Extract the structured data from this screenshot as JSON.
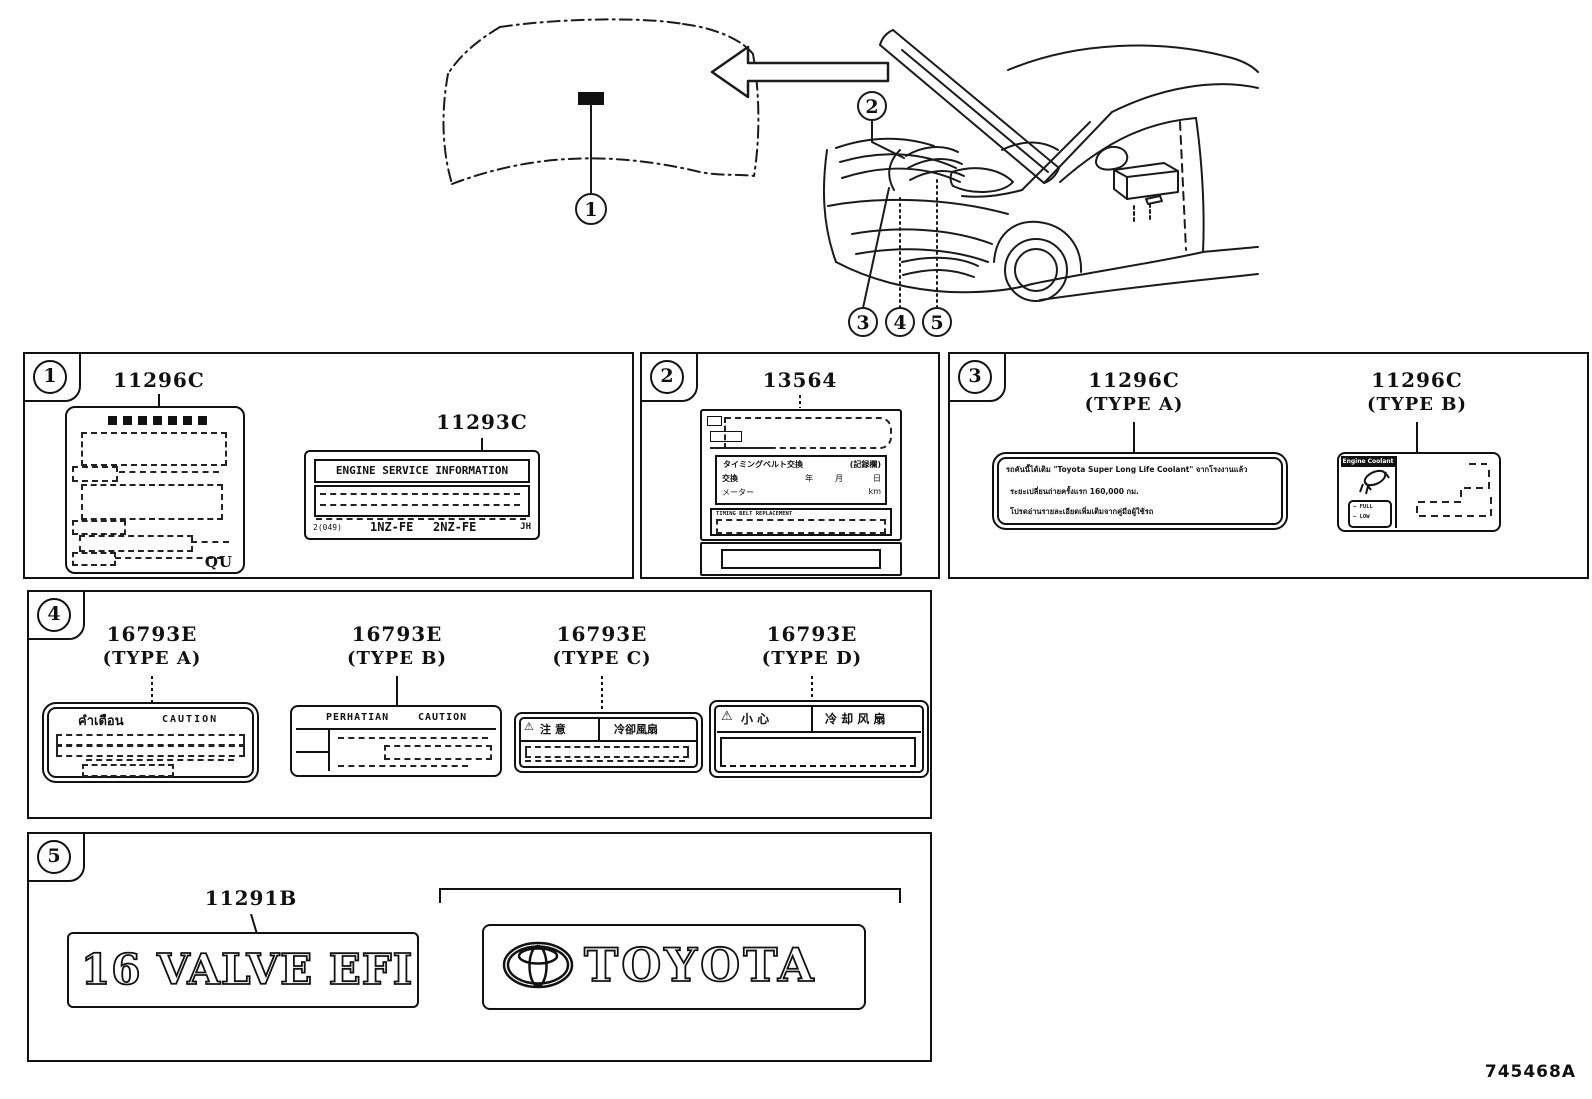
{
  "page": {
    "doc_number": "745468A"
  },
  "callouts": {
    "c1": "1",
    "c2": "2",
    "c3": "3",
    "c4": "4",
    "c5": "5"
  },
  "group1": {
    "badge": "1",
    "part1_number": "11296C",
    "part2_number": "11293C",
    "coolant_plate": {
      "corner_code": "QU"
    },
    "esi_plate": {
      "title": "ENGINE SERVICE INFORMATION",
      "code": "2(049)",
      "engine1": "1NZ-FE",
      "engine2": "2NZ-FE",
      "stamp": "JH"
    }
  },
  "group2": {
    "badge": "2",
    "part_number": "13564",
    "belt_plate": {
      "record_title": "タイミングベルト交換",
      "record_field": "(記録欄)",
      "row_replace": "交換",
      "unit_year": "年",
      "unit_month": "月",
      "unit_day": "日",
      "row_meter": "メーター",
      "unit_km": "km",
      "notice": "TIMING BELT REPLACEMENT"
    }
  },
  "group3": {
    "badge": "3",
    "partA_number": "11296C",
    "partA_type": "(TYPE A)",
    "partB_number": "11296C",
    "partB_type": "(TYPE B)",
    "thai_plate": {
      "line1": "รถคันนี้ได้เติม \"Toyota Super Long Life Coolant\" จากโรงงานแล้ว",
      "line2": "ระยะเปลี่ยนถ่ายครั้งแรก 160,000 กม.",
      "line3": "โปรดอ่านรายละเอียดเพิ่มเติมจากคู่มือผู้ใช้รถ"
    },
    "coolant_plate": {
      "title": "Engine Coolant",
      "full": "FULL",
      "low": "LOW"
    }
  },
  "group4": {
    "badge": "4",
    "partA": {
      "number": "16793E",
      "type": "(TYPE A)",
      "header_left": "คำเตือน",
      "header_right": "CAUTION"
    },
    "partB": {
      "number": "16793E",
      "type": "(TYPE B)",
      "header_left": "PERHATIAN",
      "header_right": "CAUTION"
    },
    "partC": {
      "number": "16793E",
      "type": "(TYPE C)",
      "warn": "⚠",
      "header_left": "注 意",
      "header_right": "冷卻風扇"
    },
    "partD": {
      "number": "16793E",
      "type": "(TYPE D)",
      "warn": "⚠",
      "header_left": "小 心",
      "header_right": "冷 却 风 扇"
    }
  },
  "group5": {
    "badge": "5",
    "part_number": "11291B",
    "valve_badge_text": "16 VALVE EFI",
    "brand_text": "TOYOTA"
  }
}
